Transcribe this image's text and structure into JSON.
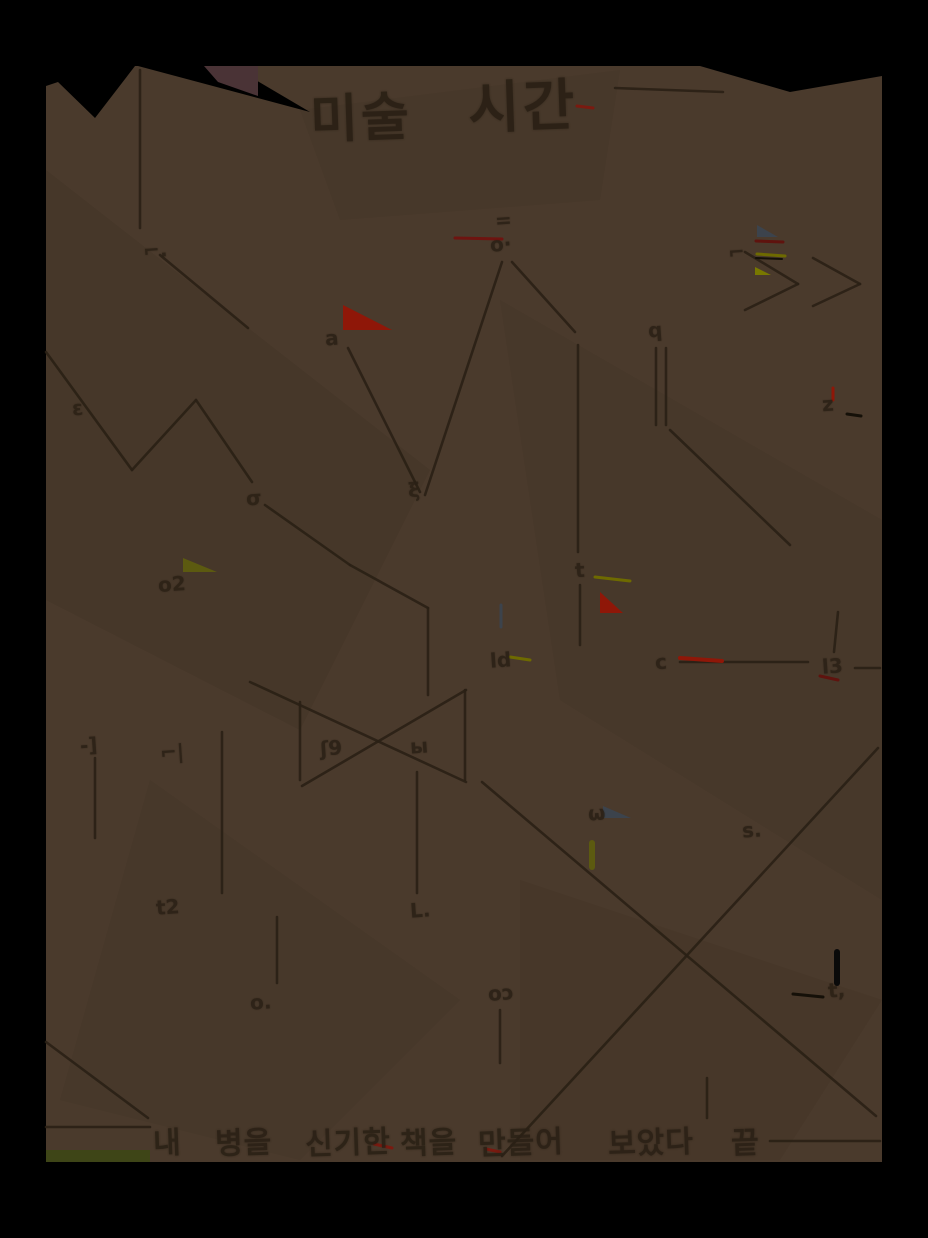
{
  "scene": {
    "description": "dark photograph of a handwritten sepia page with a hand-drawn line diagram, small scribbled labels, coloured pen accents, a handwritten title and a handwritten caption",
    "matte_color": "#000000",
    "page_color": "#4a3a2c",
    "ink_color": "#2a2015",
    "page_box": {
      "left": 46,
      "top": 66,
      "width": 836,
      "height": 1096
    }
  },
  "title": {
    "word1": "미술",
    "word2": "시간"
  },
  "caption": {
    "words": [
      "내",
      "병을",
      "신기한",
      "책을",
      "만들어",
      "보았다",
      "끝"
    ]
  },
  "marks": [
    {
      "x": 143,
      "y": 238,
      "t": "⌐."
    },
    {
      "x": 495,
      "y": 208,
      "t": "="
    },
    {
      "x": 490,
      "y": 232,
      "t": "o·"
    },
    {
      "x": 728,
      "y": 240,
      "t": "⌐"
    },
    {
      "x": 325,
      "y": 326,
      "t": "a"
    },
    {
      "x": 648,
      "y": 318,
      "t": "q"
    },
    {
      "x": 72,
      "y": 396,
      "t": "ε"
    },
    {
      "x": 822,
      "y": 392,
      "t": "z"
    },
    {
      "x": 246,
      "y": 486,
      "t": "σ"
    },
    {
      "x": 408,
      "y": 478,
      "t": "ξ"
    },
    {
      "x": 158,
      "y": 572,
      "t": "o2"
    },
    {
      "x": 575,
      "y": 558,
      "t": "t"
    },
    {
      "x": 490,
      "y": 648,
      "t": "ld"
    },
    {
      "x": 655,
      "y": 650,
      "t": "c"
    },
    {
      "x": 822,
      "y": 654,
      "t": "l3"
    },
    {
      "x": 80,
      "y": 733,
      "t": "-]"
    },
    {
      "x": 160,
      "y": 740,
      "t": "⌐|"
    },
    {
      "x": 320,
      "y": 736,
      "t": "ʃ9"
    },
    {
      "x": 410,
      "y": 734,
      "t": "ы"
    },
    {
      "x": 588,
      "y": 801,
      "t": "ω"
    },
    {
      "x": 742,
      "y": 818,
      "t": "s."
    },
    {
      "x": 156,
      "y": 895,
      "t": "t2"
    },
    {
      "x": 410,
      "y": 898,
      "t": "L."
    },
    {
      "x": 250,
      "y": 990,
      "t": "o."
    },
    {
      "x": 488,
      "y": 981,
      "t": "oɔ"
    },
    {
      "x": 828,
      "y": 978,
      "t": "t,"
    }
  ],
  "accents": [
    {
      "type": "poly",
      "pts": "343,305 343,330 392,330",
      "color": "#8f1708"
    },
    {
      "type": "line",
      "pts": [
        455,
        238,
        502,
        239
      ],
      "color": "#6e1410",
      "w": 3
    },
    {
      "type": "line",
      "pts": [
        577,
        106,
        593,
        108
      ],
      "color": "#7a1a10",
      "w": 3
    },
    {
      "type": "line",
      "pts": [
        833,
        388,
        833,
        400
      ],
      "color": "#8f1708",
      "w": 3
    },
    {
      "type": "poly",
      "pts": "183,558 217,572 183,572",
      "color": "#5c5a10"
    },
    {
      "type": "line",
      "pts": [
        595,
        577,
        630,
        581
      ],
      "color": "#6e6a00",
      "w": 3
    },
    {
      "type": "poly",
      "pts": "600,592 600,613 623,613",
      "color": "#8f1708"
    },
    {
      "type": "poly",
      "pts": "757,225 778,237 757,237",
      "color": "#3c434c"
    },
    {
      "type": "line",
      "pts": [
        756,
        241,
        783,
        242
      ],
      "color": "#5f130e",
      "w": 3
    },
    {
      "type": "line",
      "pts": [
        757,
        254,
        785,
        256
      ],
      "color": "#6e6a00",
      "w": 3
    },
    {
      "type": "line",
      "pts": [
        756,
        258,
        782,
        259
      ],
      "color": "#141008",
      "w": 2
    },
    {
      "type": "poly",
      "pts": "755,267 771,275 755,275",
      "color": "#787800"
    },
    {
      "type": "poly",
      "pts": "603,806 631,818 603,818",
      "color": "#3c434c"
    },
    {
      "type": "line",
      "pts": [
        592,
        843,
        592,
        867
      ],
      "color": "#5c5a10",
      "w": 6
    },
    {
      "type": "line",
      "pts": [
        501,
        605,
        501,
        627
      ],
      "color": "#3c434c",
      "w": 3
    },
    {
      "type": "line",
      "pts": [
        510,
        657,
        530,
        660
      ],
      "color": "#6e6a00",
      "w": 3
    },
    {
      "type": "line",
      "pts": [
        680,
        658,
        722,
        661
      ],
      "color": "#8f1708",
      "w": 4
    },
    {
      "type": "line",
      "pts": [
        820,
        676,
        838,
        680
      ],
      "color": "#5f130e",
      "w": 3
    },
    {
      "type": "line",
      "pts": [
        374,
        1144,
        392,
        1148
      ],
      "color": "#7a1a10",
      "w": 3
    },
    {
      "type": "line",
      "pts": [
        486,
        1149,
        500,
        1152
      ],
      "color": "#7a1a10",
      "w": 3
    },
    {
      "type": "rect",
      "pts": [
        46,
        1150,
        104,
        12
      ],
      "color": "#3e4517"
    },
    {
      "type": "line",
      "pts": [
        837,
        952,
        837,
        983
      ],
      "color": "#0a0a0a",
      "w": 6
    },
    {
      "type": "line",
      "pts": [
        793,
        994,
        823,
        997
      ],
      "color": "#151008",
      "w": 3
    },
    {
      "type": "line",
      "pts": [
        847,
        414,
        861,
        416
      ],
      "color": "#151008",
      "w": 3
    },
    {
      "type": "poly",
      "pts": "204,66 258,66 258,96 218,82",
      "color": "#4a3336"
    }
  ]
}
